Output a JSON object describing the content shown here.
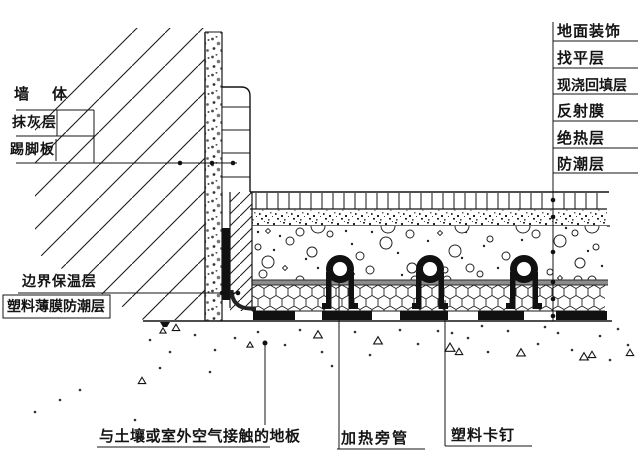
{
  "diagram": {
    "left_labels": {
      "wall": "墙　体",
      "plaster": "抹灰层",
      "skirting": "踢脚板"
    },
    "mid_left_labels": {
      "edge_insulation": "边界保温层",
      "plastic_film_barrier": "塑料薄膜防潮层"
    },
    "right_labels": [
      "地面装饰",
      "找平层",
      "现浇回填层",
      "反射膜",
      "绝热层",
      "防潮层"
    ],
    "bottom_labels": {
      "ground_floor": "与土壤或室外空气接触的地板",
      "heating_pipe": "加热旁管",
      "plastic_clip": "塑料卡钉"
    },
    "colors": {
      "line": "#141414",
      "film": "#8c8c8c",
      "background": "#ffffff"
    }
  }
}
